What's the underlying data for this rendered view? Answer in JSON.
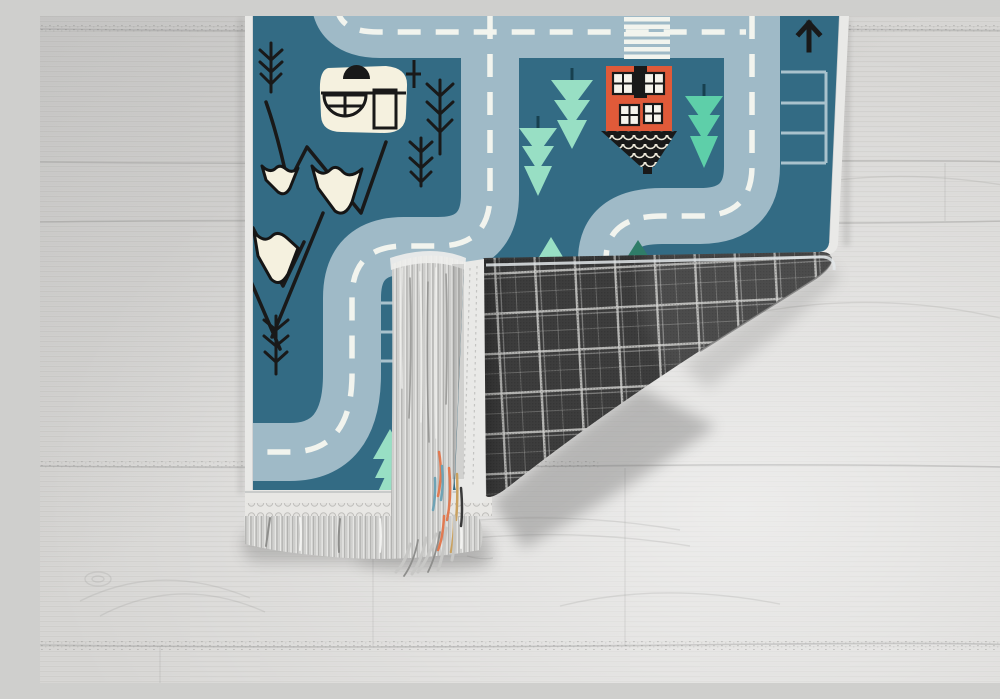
{
  "scene": {
    "type": "product-photo",
    "subject": "Children's play rug with teal road-map print (roads, helicopter, house, mountains, pine trees, parking bays), bottom-right corner folded over showing dark plaid woven backing and knotted fringe tassels, lying on a whitewashed wood plank floor"
  },
  "palette": {
    "teal": "#336b84",
    "road": "#9fbac7",
    "roadLine": "#f2f4ee",
    "bayLine": "#a9c2cd",
    "mintLight": "#98dfc4",
    "mintMedium": "#5ecfa9",
    "pineDark": "#2f7d68",
    "ink": "#191919",
    "cream": "#f5f1df",
    "houseOrange": "#e05a39",
    "plaidBase": "#424242",
    "plaidLine": "#d4d4d2",
    "binding": "#e9e9e7",
    "hem": "#e8e7e4",
    "fringeLight": "#f2f2f0",
    "fringeMid": "#c7c7c5",
    "fringeDark": "#8e8e8c",
    "fringeOrange": "#e07a52",
    "fringeTan": "#c9a15f",
    "fringeBlue": "#6fa3b5",
    "stemDark": "#17404f",
    "floor": "#d8d7d5",
    "floorLine": "#8a8a88"
  },
  "rug": {
    "front": {
      "background_color_key": "teal",
      "roads": {
        "count": 3,
        "surface_color_key": "road",
        "center_line_style": "white dashed"
      },
      "crosswalk_stripes": 6,
      "parking_bays_top_right": 3,
      "parking_bays_left": 3,
      "features": [
        {
          "name": "helicopter",
          "color_key": "cream"
        },
        {
          "name": "mountain-peaks",
          "count": 3,
          "color_key": "cream"
        },
        {
          "name": "house",
          "color_key": "houseOrange",
          "windows": 4,
          "roof": "black scalloped shingles",
          "door": "black"
        },
        {
          "name": "mint-pine-trees",
          "count": 6
        },
        {
          "name": "black-twig-trees",
          "count": 4
        },
        {
          "name": "direction-arrow",
          "direction": "up"
        },
        {
          "name": "cloud-partial",
          "circles": 2
        }
      ]
    },
    "back": {
      "pattern": "plaid",
      "grid_px": 40,
      "base_color_key": "plaidBase",
      "line_color_key": "plaidLine"
    },
    "edges": {
      "binding_color_key": "binding",
      "fringe_style": "knotted tassels",
      "fringe_color_key": "fringeMid",
      "fringe_accent_color_keys": [
        "fringeOrange",
        "fringeTan",
        "fringeBlue"
      ]
    }
  },
  "floor": {
    "material": "whitewashed wood planks",
    "color_key": "floor",
    "plank_line_y": [
      14,
      146,
      205,
      450,
      630
    ]
  }
}
